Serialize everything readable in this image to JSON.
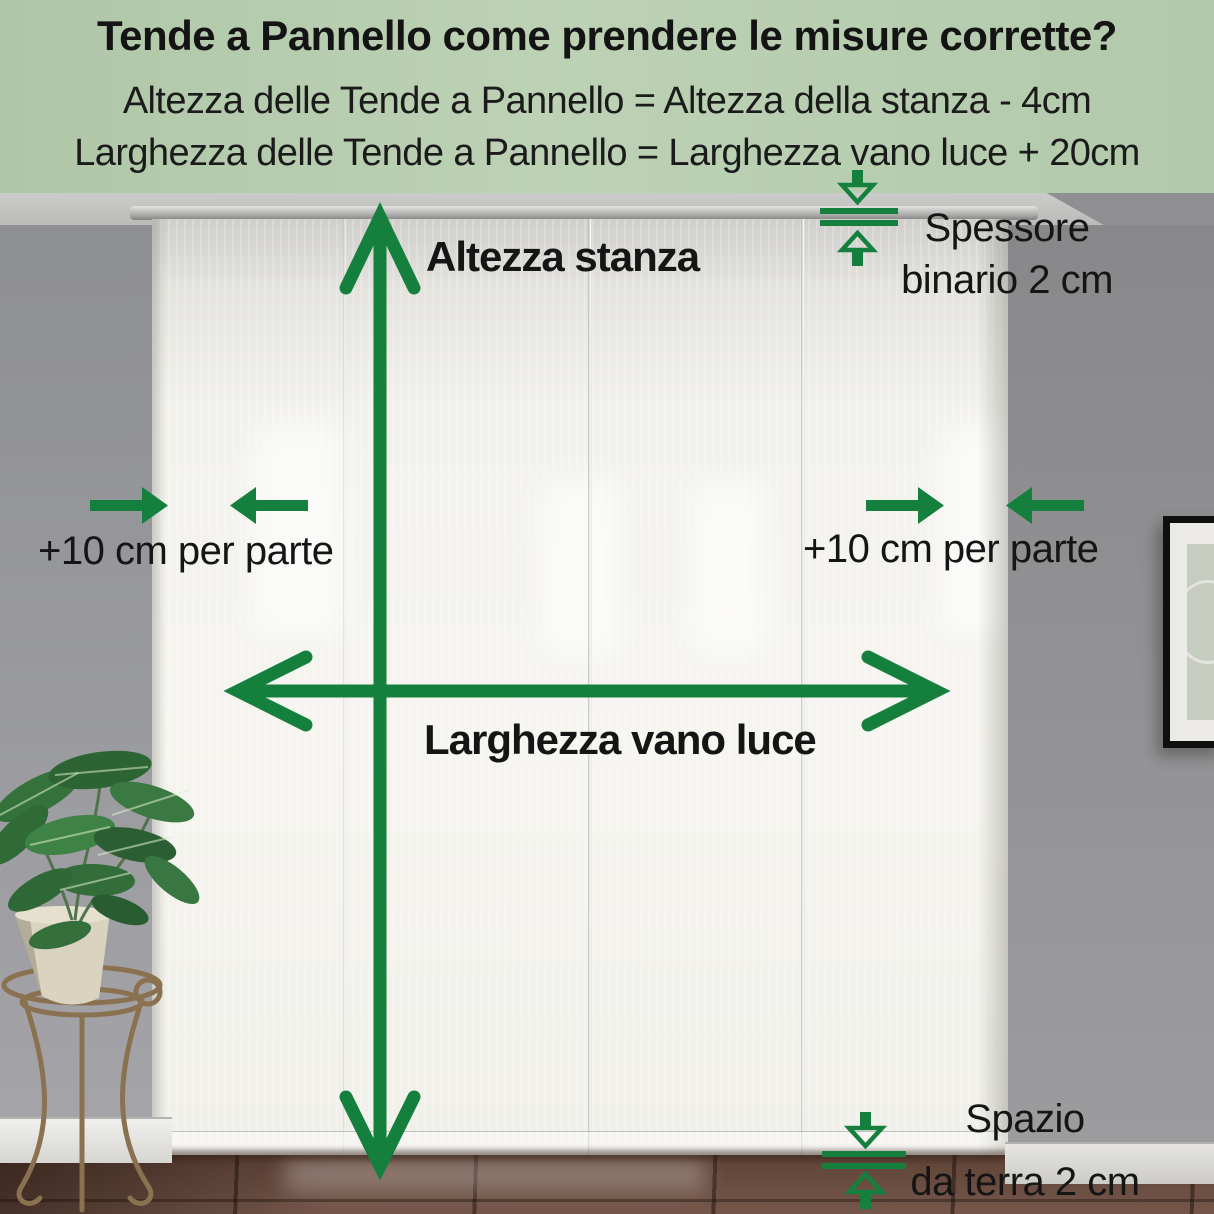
{
  "header": {
    "title": "Tende a Pannello come prendere le misure corrette?",
    "formula_height": "Altezza delle Tende a Pannello = Altezza della stanza - 4cm",
    "formula_width": "Larghezza delle Tende a Pannello = Larghezza vano luce + 20cm"
  },
  "diagram": {
    "room_height_label": "Altezza stanza",
    "opening_width_label": "Larghezza vano luce",
    "track_thickness_line1": "Spessore",
    "track_thickness_line2": "binario 2 cm",
    "side_margin_left_label": "+10 cm per parte",
    "side_margin_right_label": "+10 cm per parte",
    "floor_gap_line1": "Spazio",
    "floor_gap_line2": "da terra 2 cm"
  },
  "icons": {
    "vertical_measure": "double-headed-arrow-vertical",
    "horizontal_measure": "double-headed-arrow-horizontal",
    "side_margin_markers": "converging-solid-arrows",
    "gap_markers": "hollow-arrows-with-parallel-lines"
  },
  "colors": {
    "accent_green": "#15803e",
    "header_background": "#b6cdae",
    "text": "#161616"
  }
}
